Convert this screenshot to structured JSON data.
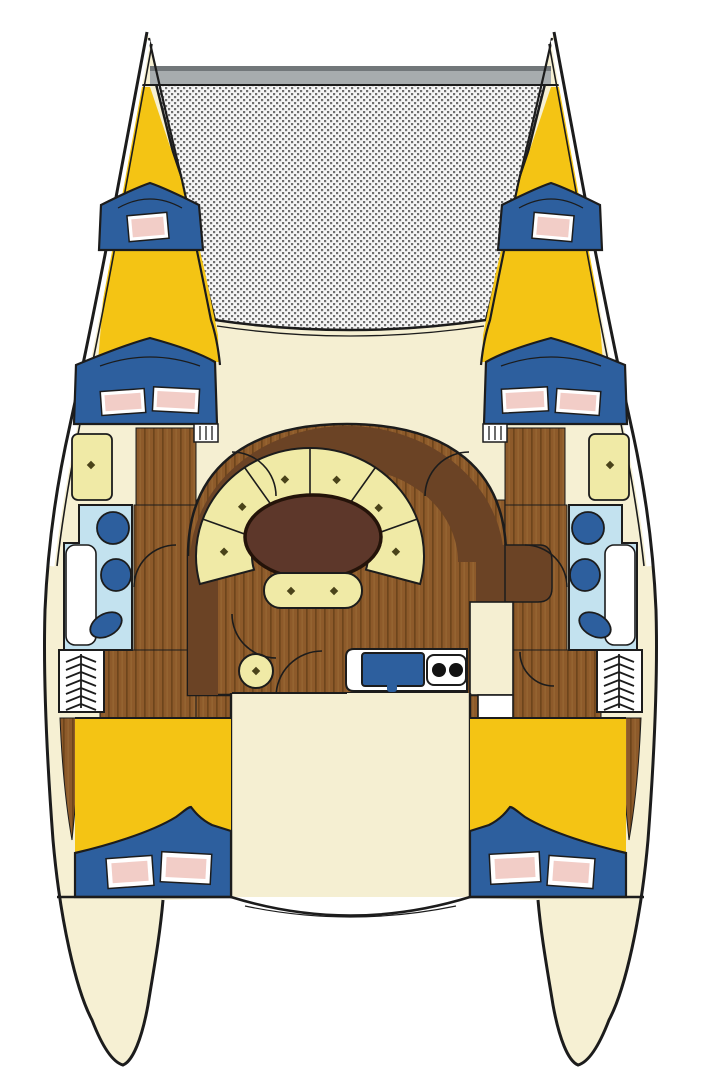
{
  "meta": {
    "title": "Catamaran interior deck plan",
    "diagram_type": "boat-floor-plan",
    "view": "top-down, bow at top"
  },
  "palette": {
    "background": "#ffffff",
    "outline": "#1c1c1c",
    "hull": "#f6f0d3",
    "deck": "#f5efd2",
    "accent_yellow": "#f4c414",
    "berth_navy": "#2d5f9e",
    "pillow_pink": "#f2cdc7",
    "pillow_white": "#ffffff",
    "wood_base": "#8d5a2a",
    "wood_stripe": "#6e451c",
    "wood_stripe2": "#9a6a35",
    "salon_dark": "#6b4325",
    "cabinet_brown": "#5c3a1e",
    "table_brown": "#5d372a",
    "table_outline": "#241309",
    "cushion_cream": "#f0eaa6",
    "button_olive": "#4a431a",
    "bath_blue": "#c3e2ef",
    "fixture_navy": "#2d5f9e",
    "counter_white": "#ffffff",
    "burner_black": "#121212",
    "beam_gray": "#a7acae",
    "beam_gray_dark": "#72777a",
    "net_dot": "#6f6f6f",
    "net_bg": "#f5f5f5"
  },
  "areas": {
    "bow": {
      "trampoline": "trampoline net between hulls",
      "crossbeam": "forward crossbeam",
      "port_bow_deck": "yellow bow deck",
      "starboard_bow_deck": "yellow bow deck"
    },
    "cabins": {
      "port_forward_vberth": {
        "pillows": 1
      },
      "starboard_forward_vberth": {
        "pillows": 1
      },
      "port_forward_double_berth": {
        "pillows": 2
      },
      "starboard_forward_double_berth": {
        "pillows": 2
      },
      "port_aft_double_berth": {
        "pillows": 2
      },
      "starboard_aft_double_berth": {
        "pillows": 2
      }
    },
    "heads": {
      "port_head_fixtures": 3,
      "starboard_head_fixtures": 3,
      "shower_trays": 2
    },
    "salon": {
      "settee_sections": 6,
      "bench_cushions": 2,
      "stool": 1,
      "table": "oval dining table"
    },
    "galley": {
      "sink": 1,
      "stove_burners": 2,
      "cabinet": "aft galley cabinet"
    },
    "companionways": {
      "hull_ladders": 2,
      "step_icons": 2
    },
    "cockpit": {
      "bench": "curved transom bench"
    }
  }
}
